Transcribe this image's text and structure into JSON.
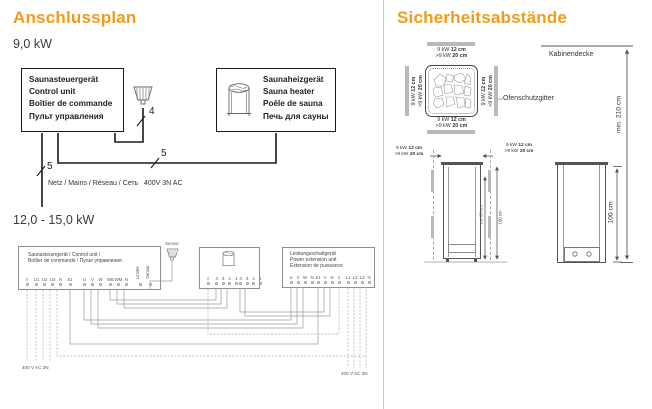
{
  "colors": {
    "accent": "#F29C1B"
  },
  "icons": {
    "sensor": "sensor-icon",
    "heater": "heater-icon",
    "stones_top_view": "heater-stones-top-icon",
    "earth": "earth-ground-symbol"
  },
  "left": {
    "title": "Anschlussplan",
    "kw9": {
      "subtitle": "9,0 kW",
      "control_unit": {
        "lines": [
          "Saunasteuergerät",
          "Control unit",
          "Boîtier de commande",
          "Пульт управления"
        ]
      },
      "heater": {
        "lines": [
          "Saunaheizgerät",
          "Sauna heater",
          "Poêle de sauna",
          "Печь для сауны"
        ]
      },
      "wire4": "4",
      "wire5_heater": "5",
      "wire5_mains": "5",
      "mains_label": "Netz / Mains / Réseau / Сеть",
      "mains_voltage": "400V 3N AC"
    },
    "kw12": {
      "subtitle": "12,0 - 15,0 kW",
      "control_unit": {
        "line1": "Saunasteuergerät / Control unit /",
        "line2": "Boîtier de commande / Пульт управления",
        "g_earth": [
          "⏚"
        ],
        "g_mains": [
          "U1",
          "U2",
          "U3",
          "N"
        ],
        "g_s1": [
          "S1"
        ],
        "g_uvw": [
          "U",
          "V",
          "W"
        ],
        "g_wbwm": [
          "WB",
          "WM",
          "N"
        ],
        "g_vert": [
          "Limiter",
          "Sensor"
        ]
      },
      "sensor_label": "Sensor",
      "heater_box": {
        "g_earth": [
          "⏚"
        ],
        "g_a": [
          "4",
          "3",
          "2",
          "1"
        ],
        "g_b": [
          "4",
          "3",
          "2",
          "1"
        ]
      },
      "power_unit": {
        "lines": [
          "Leistungsschaltgerät",
          "Power extension unit",
          "Extension de puissance"
        ],
        "g_uvwn": [
          "U",
          "V",
          "W",
          "N"
        ],
        "g_s1vn": [
          "S1",
          "V",
          "N"
        ],
        "g_earth": [
          "⏚"
        ],
        "g_mains": [
          "L1",
          "L2",
          "L3",
          "N"
        ]
      },
      "voltage_left": "400 V AC 3N",
      "voltage_right": "400 V AC 3N"
    }
  },
  "right": {
    "title": "Sicherheitsabstände",
    "clearance": {
      "p9": "9 kW",
      "v9": "12 cm",
      "pgt": ">9 kW",
      "vgt": "20 cm"
    },
    "kabinendecke": "Kabinendecke",
    "ofenschutzgitter": "Ofenschutzgitter",
    "min_height": "min. 210 cm",
    "dim_ca85": "ca. 85 cm",
    "dim_100": "100 cm",
    "dim_100_side": "100 cm"
  }
}
